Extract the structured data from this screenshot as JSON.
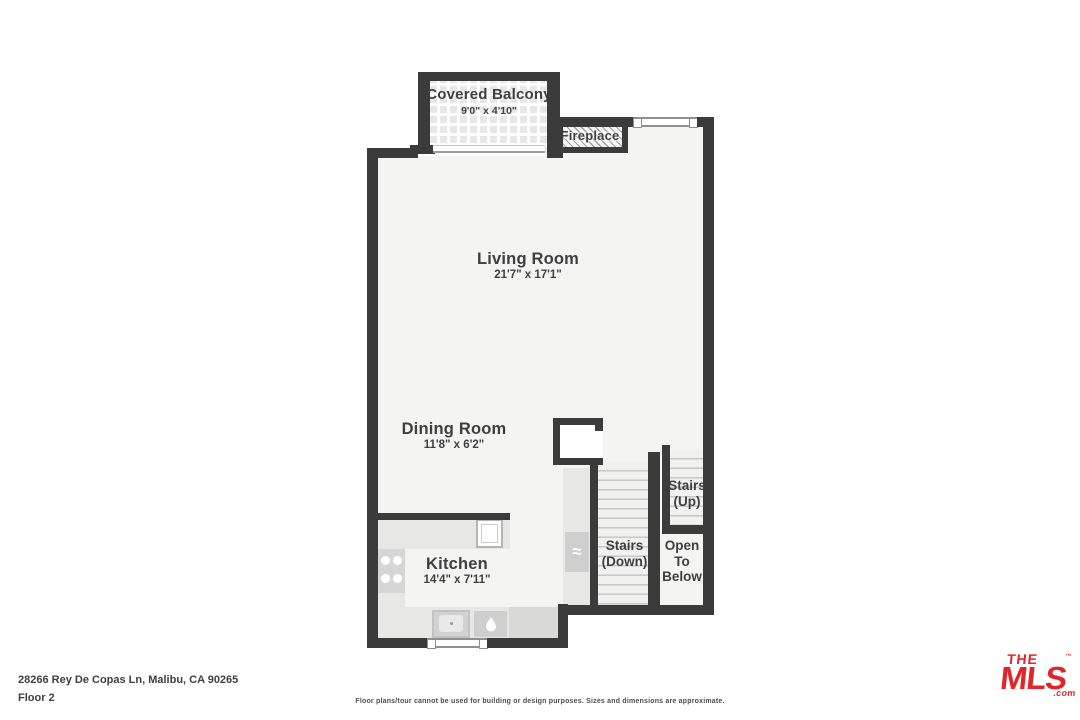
{
  "rooms": {
    "covered_balcony": {
      "name": "Covered Balcony",
      "dims": "9'0\" x 4'10\""
    },
    "fireplace": {
      "name": "Fireplace"
    },
    "living_room": {
      "name": "Living Room",
      "dims": "21'7\" x 17'1\""
    },
    "dining_room": {
      "name": "Dining Room",
      "dims": "11'8\" x 6'2\""
    },
    "kitchen": {
      "name": "Kitchen",
      "dims": "14'4\" x 7'11\""
    },
    "stairs_up": {
      "line1": "Stairs",
      "line2": "(Up)"
    },
    "stairs_down": {
      "line1": "Stairs",
      "line2": "(Down)"
    },
    "open_to_below": {
      "line1": "Open",
      "line2": "To",
      "line3": "Below"
    }
  },
  "icons": {
    "appliance_waves": "≈"
  },
  "footer": {
    "address": "28266 Rey De Copas Ln, Malibu, CA 90265",
    "floor_label": "Floor 2",
    "disclaimer": "Floor plans/tour cannot be used for building or design purposes. Sizes and dimensions are approximate."
  },
  "logo": {
    "the": "THE",
    "tm": "™",
    "mls": "MLS",
    "com": ".com"
  },
  "colors": {
    "wall": "#3b3b3c",
    "floor": "#f4f4f3",
    "floor_stairs": "#f1f1f0",
    "counter": "#e7e7e6",
    "appliance": "#cfcfcf",
    "tread": "#c8c8c8",
    "label": "#3e3f41",
    "footer_text": "#3e3f41",
    "logo_red": "#e32429"
  }
}
